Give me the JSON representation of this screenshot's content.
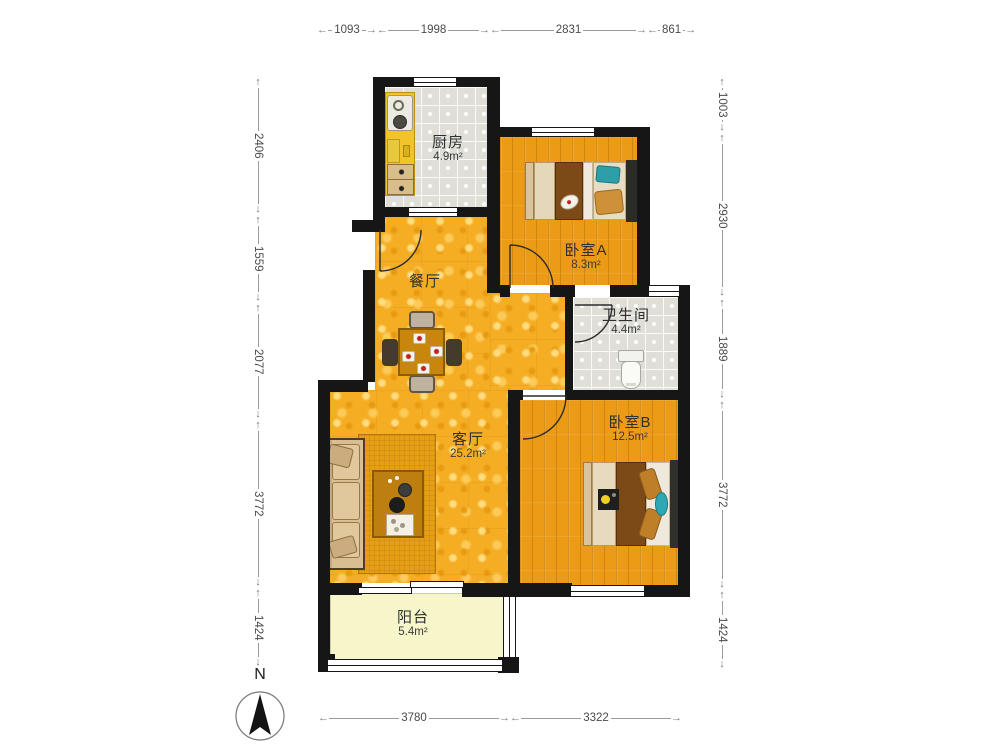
{
  "rooms": {
    "kitchen": {
      "name": "厨房",
      "area": "4.9m²"
    },
    "bedroomA": {
      "name": "卧室A",
      "area": "8.3m²"
    },
    "bathroom": {
      "name": "卫生间",
      "area": "4.4m²"
    },
    "bedroomB": {
      "name": "卧室B",
      "area": "12.5m²"
    },
    "dining": {
      "name": "餐厅",
      "area": ""
    },
    "living": {
      "name": "客厅",
      "area": "25.2m²"
    },
    "balcony": {
      "name": "阳台",
      "area": "5.4m²"
    }
  },
  "dims": {
    "top": [
      "1093",
      "1998",
      "2831",
      "861"
    ],
    "left": [
      "2406",
      "1559",
      "2077",
      "3772",
      "1424"
    ],
    "right": [
      "1003",
      "2930",
      "1889",
      "3772",
      "1424"
    ],
    "bottom": [
      "3780",
      "3322"
    ]
  },
  "compass": {
    "north_label": "N"
  },
  "colors": {
    "wall": "#161616",
    "floor_public": "#F5AE24",
    "floor_bedroom": "#EC9B16",
    "floor_tile": "#DFDFD8",
    "floor_balcony": "#F6F6CA",
    "accent_teal": "#2FA8B5",
    "blanket_brown": "#7B4A16",
    "dim_text": "#4a4a4a"
  },
  "furniture": {
    "kitchen": [
      "counter",
      "sink",
      "stove",
      "drawers"
    ],
    "bedroomA": [
      "single-bed"
    ],
    "bedroomB": [
      "double-bed",
      "tray"
    ],
    "bathroom": [
      "toilet"
    ],
    "dining": [
      "dining-table",
      "chairs",
      "plates"
    ],
    "living": [
      "sofa",
      "rug",
      "coffee-table",
      "tray"
    ]
  }
}
